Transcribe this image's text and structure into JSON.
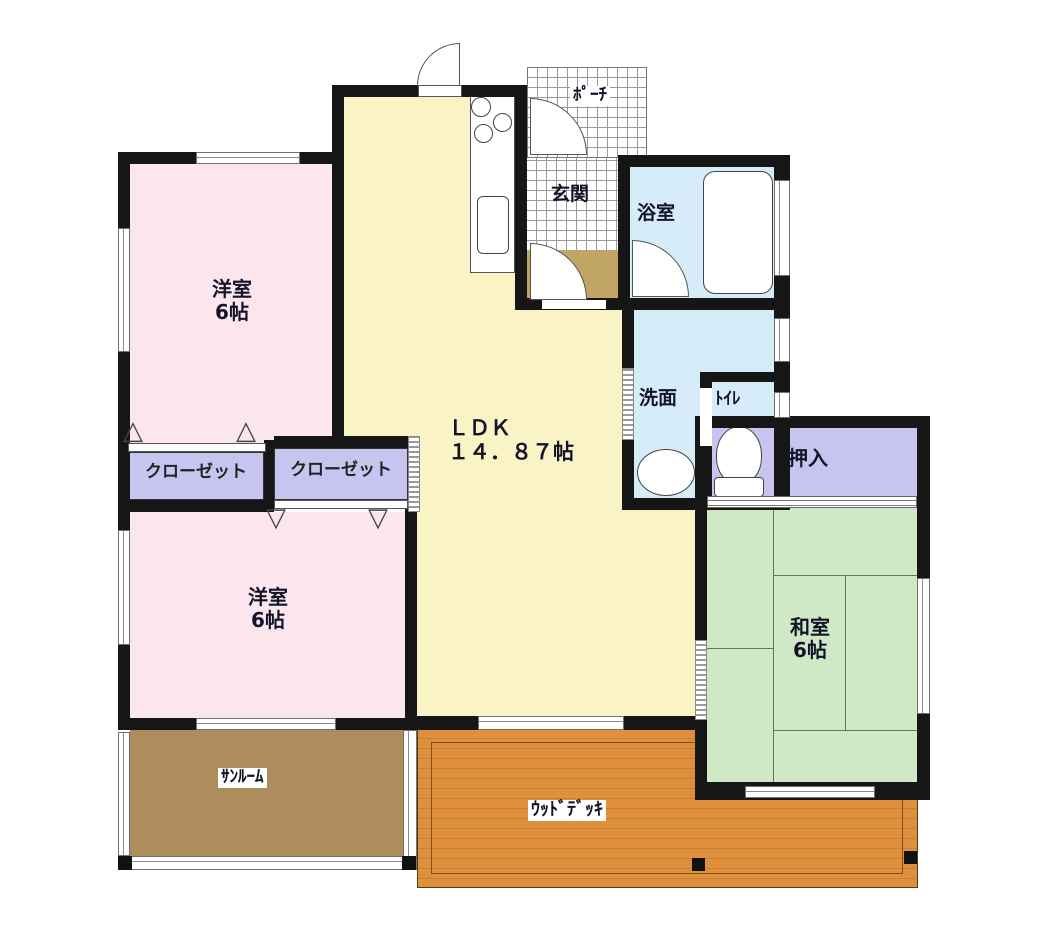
{
  "plan": {
    "rooms": {
      "bedroom_top": {
        "label": "洋室",
        "size": "6帖"
      },
      "bedroom_bottom": {
        "label": "洋室",
        "size": "6帖"
      },
      "closet_left": {
        "label": "クローゼット"
      },
      "closet_right": {
        "label": "クローゼット"
      },
      "ldk": {
        "label": "ＬＤＫ",
        "size": "１４．８７帖"
      },
      "porch": {
        "label": "ﾎﾟｰﾁ"
      },
      "entrance": {
        "label": "玄関"
      },
      "bathroom": {
        "label": "浴室"
      },
      "washroom": {
        "label": "洗面"
      },
      "toilet": {
        "label": "ﾄｲﾚ"
      },
      "oshiire": {
        "label": "押入"
      },
      "japanese_room": {
        "label": "和室",
        "size": "6帖"
      },
      "sunroom": {
        "label": "ｻﾝﾙｰﾑ"
      },
      "wood_deck": {
        "label": "ｳｯﾄﾞﾃﾞｯｷ"
      }
    },
    "colors": {
      "wall": "#161616",
      "bedroom": "#fce6ee",
      "ldk": "#faf3c6",
      "wet_rooms": "#d6ecf8",
      "closet": "#c6c5ef",
      "tatami": "#cfe9c6",
      "sunroom": "#ad8d5b",
      "wood_deck": "#de903c",
      "entrance_step": "#c1a565"
    },
    "fixtures": [
      "kitchen-stove",
      "kitchen-sink",
      "bathtub",
      "washbasin",
      "toilet-bowl"
    ]
  }
}
